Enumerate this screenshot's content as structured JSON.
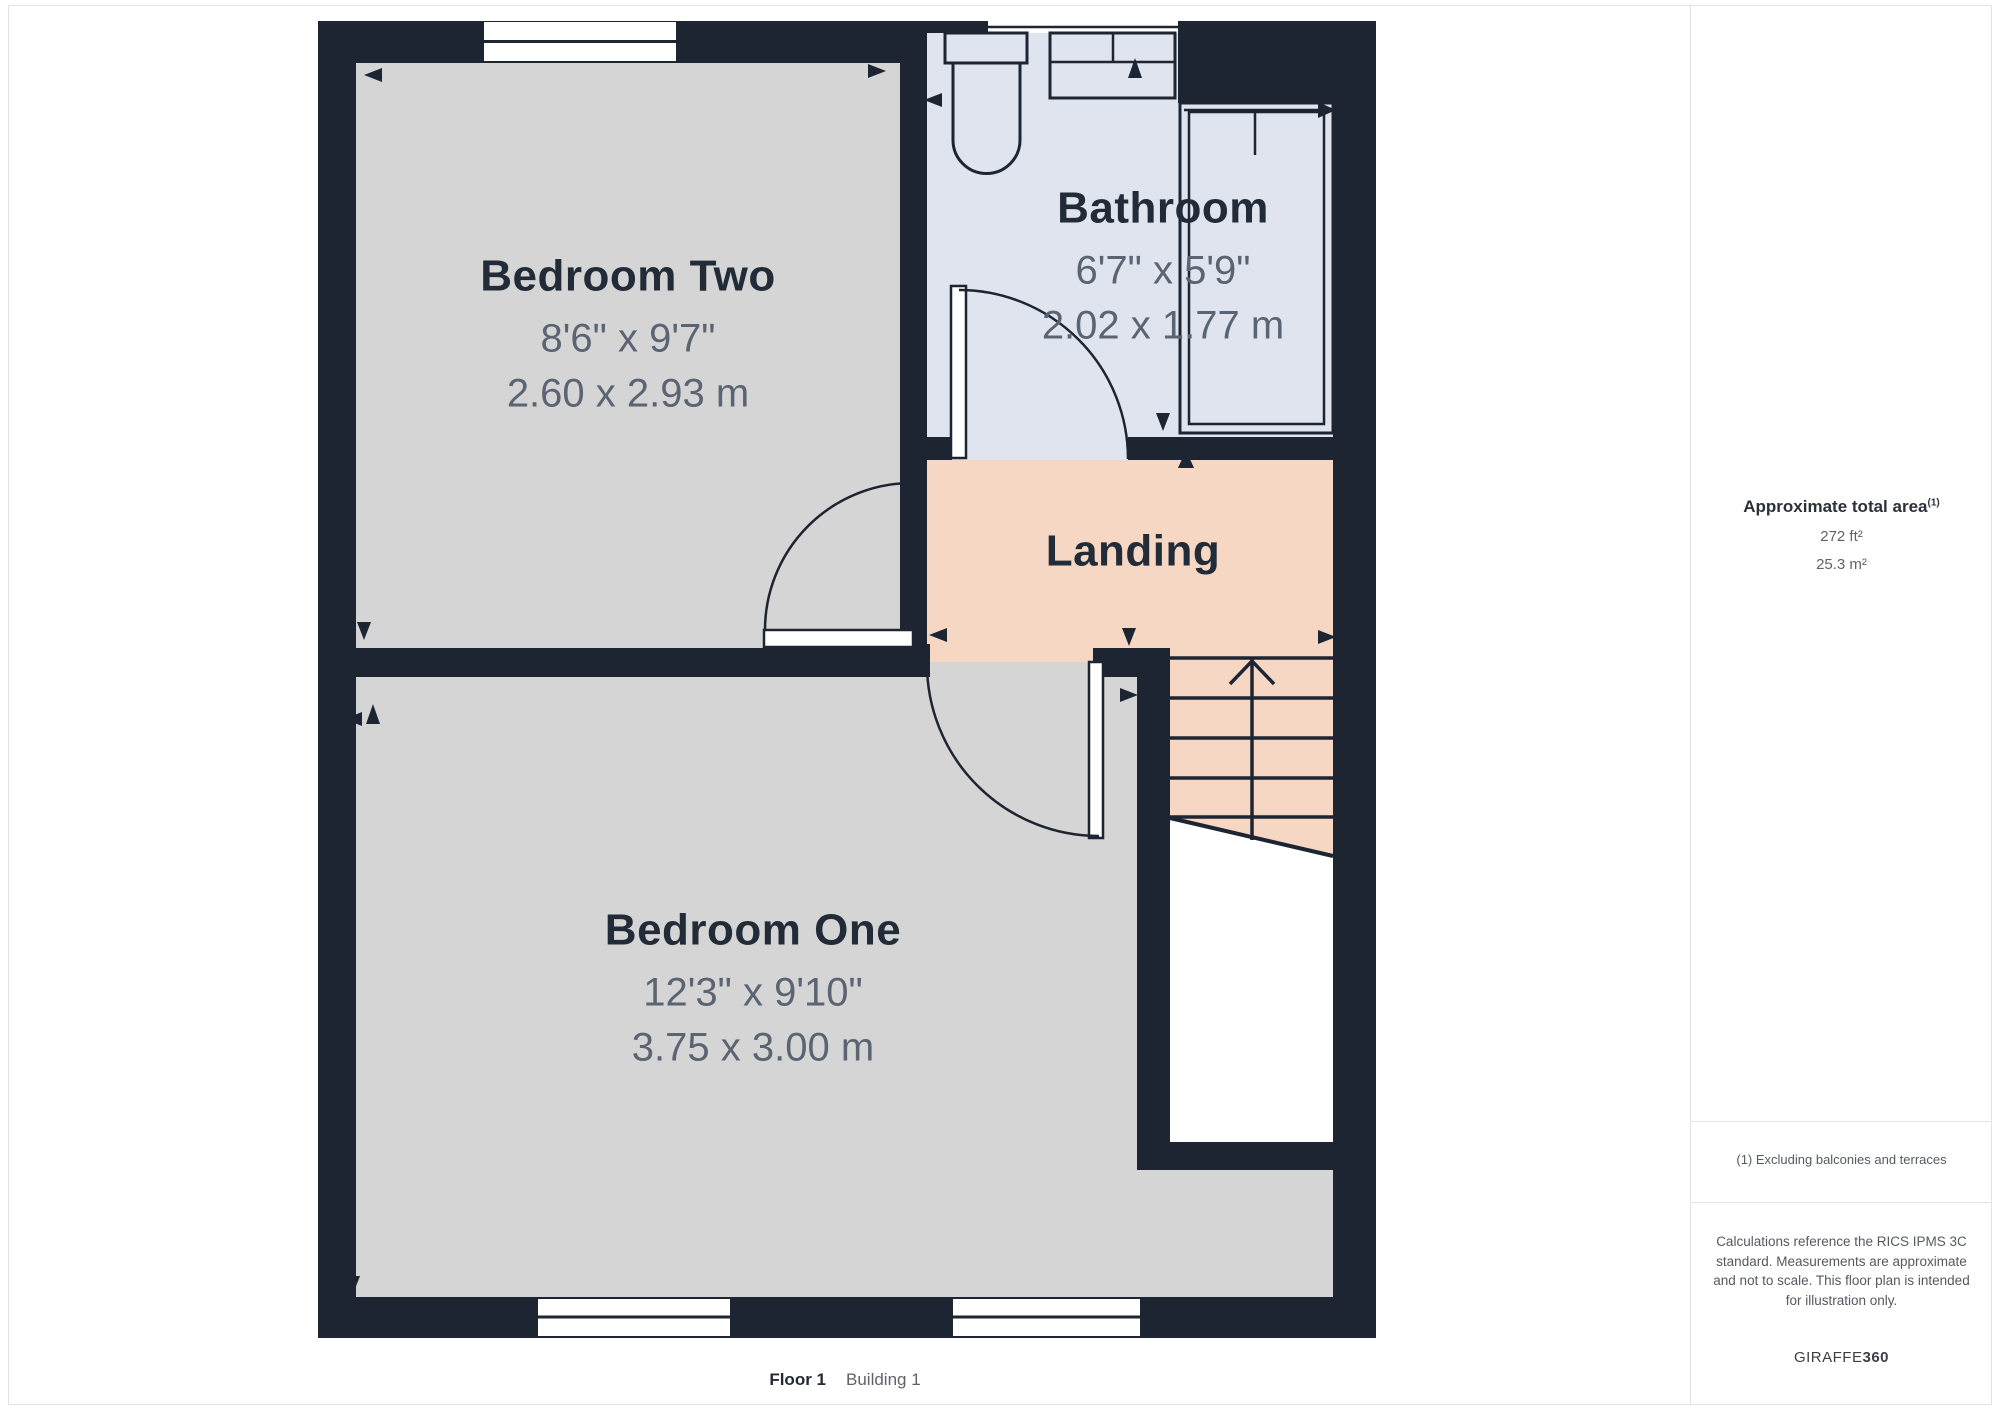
{
  "floorplan": {
    "rooms": [
      {
        "name": "Bedroom Two",
        "imperial": "8'6\" x 9'7\"",
        "metric": "2.60 x 2.93 m"
      },
      {
        "name": "Bathroom",
        "imperial": "6'7\" x 5'9\"",
        "metric": "2.02 x 1.77 m"
      },
      {
        "name": "Landing",
        "imperial": "",
        "metric": ""
      },
      {
        "name": "Bedroom One",
        "imperial": "12'3\" x 9'10\"",
        "metric": "3.75 x 3.00 m"
      }
    ],
    "caption": {
      "floor": "Floor 1",
      "building": "Building 1"
    }
  },
  "sidebar": {
    "area_title": "Approximate total area",
    "area_title_superscript": "(1)",
    "area_imperial": "272 ft²",
    "area_metric": "25.3 m²",
    "footnote": "(1) Excluding balconies and terraces",
    "disclaimer": "Calculations reference the RICS IPMS 3C standard. Measurements are approximate and not to scale. This floor plan is intended for illustration only.",
    "brand": {
      "name": "GIRAFFE",
      "suffix": "360"
    }
  },
  "colors": {
    "wall": "#1e2532",
    "ink": "#222b38",
    "bedroom": "#d5d5d5",
    "bathroom": "#dfe4ee",
    "landing": "#f6d7c3",
    "dim_text": "#5b6472",
    "muted_text": "#5f6368",
    "border": "#e3e3e3"
  }
}
